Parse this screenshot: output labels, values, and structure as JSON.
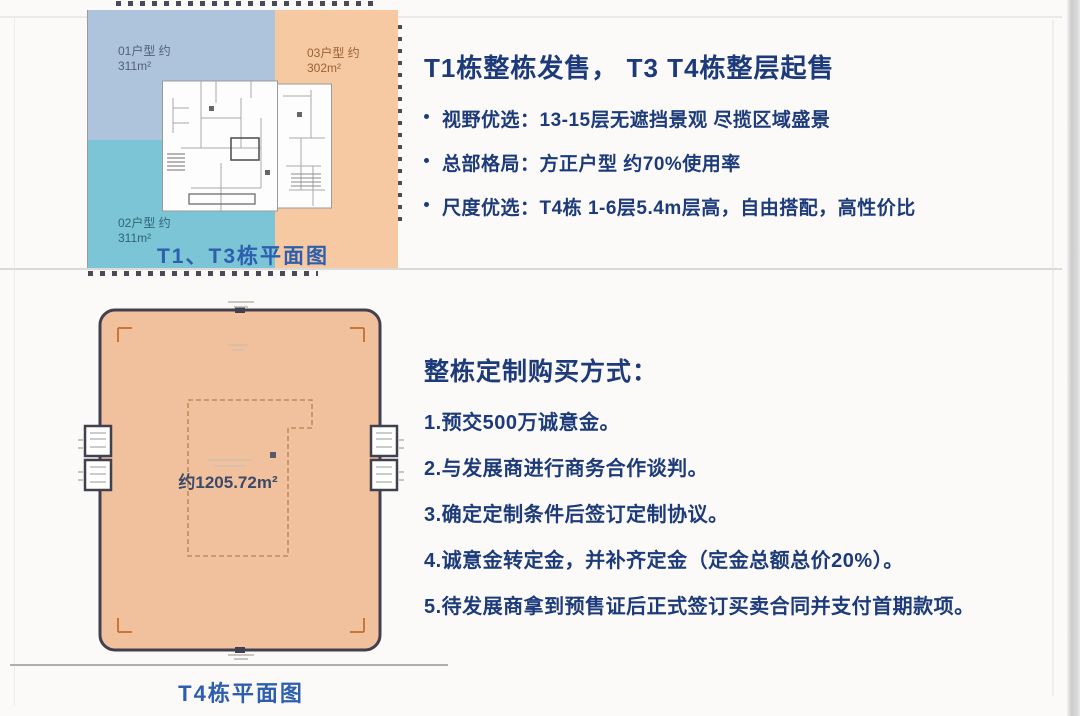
{
  "top_plan": {
    "caption": "T1、T3栋平面图",
    "units": [
      {
        "name": "01户型 约",
        "area": "311m²"
      },
      {
        "name": "02户型 约",
        "area": "311m²"
      },
      {
        "name": "03户型 约",
        "area": "302m²"
      }
    ]
  },
  "sales": {
    "title": "T1栋整栋发售， T3 T4栋整层起售",
    "bullets": [
      "视野优选：13-15层无遮挡景观 尽揽区域盛景",
      "总部格局：方正户型 约70%使用率",
      "尺度优选：T4栋 1-6层5.4m层高，自由搭配，高性价比"
    ]
  },
  "t4_plan": {
    "caption": "T4栋平面图",
    "area": "约1205.72m²"
  },
  "purchase": {
    "title": "整栋定制购买方式：",
    "steps": [
      "1.预交500万诚意金。",
      "2.与发展商进行商务合作谈判。",
      "3.确定定制条件后签订定制协议。",
      "4.诚意金转定金，并补齐定金（定金总额总价20%）。",
      "5.待发展商拿到预售证后正式签订买卖合同并支付首期款项。"
    ]
  },
  "colors": {
    "heading_navy": "#1d3b7a",
    "caption_blue": "#2e5fae",
    "unit01_fill": "#aec3dc",
    "unit02_fill": "#7cc5d6",
    "unit03_fill": "#f6c9a3",
    "t4_fill": "#f1c19e",
    "t4_border": "#40404f"
  }
}
